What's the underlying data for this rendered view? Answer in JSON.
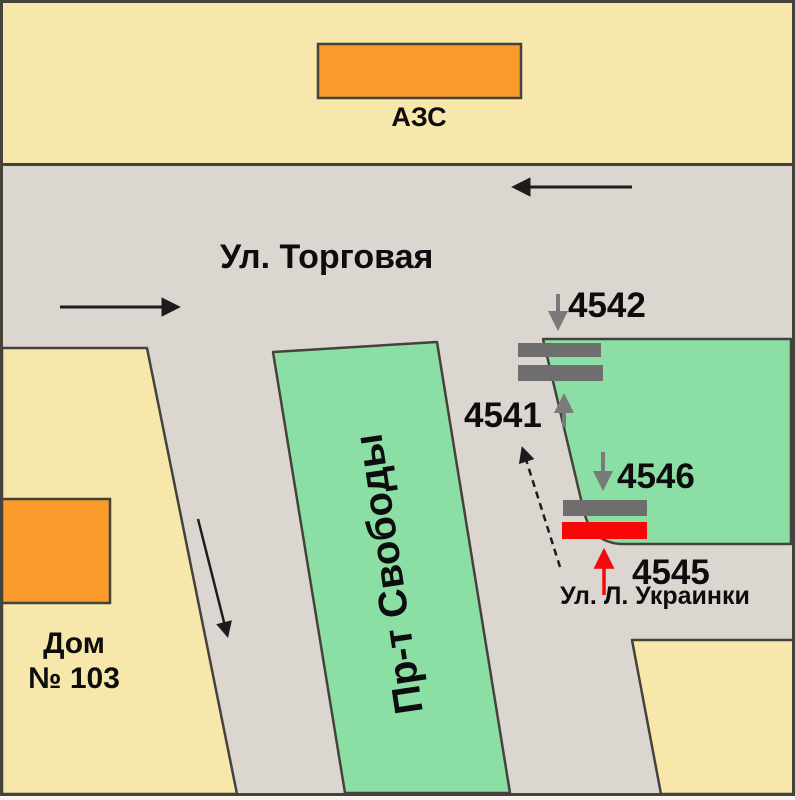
{
  "labels": {
    "gas_station": "АЗС",
    "street_torgovaya": "Ул. Торговая",
    "prospekt_svobody": "Пр-т Свободы",
    "house_line1": "Дом",
    "house_line2": "№ 103",
    "street_ukrainki": "Ул. Л. Украинки"
  },
  "billboards": [
    {
      "id": "4542"
    },
    {
      "id": "4541"
    },
    {
      "id": "4546"
    },
    {
      "id": "4545"
    }
  ],
  "colors": {
    "block_fill": "#f7e7ab",
    "road_fill": "#dcd6d1",
    "green_fill": "#8bdfa4",
    "building_fill": "#f99a2b",
    "panel_gray": "#6e6e6e",
    "panel_red": "#f70707",
    "outline": "#45423c",
    "arrow_black": "#1c1c1c",
    "arrow_gray": "#7a7a7a",
    "arrow_red": "#f40a0a",
    "text": "#0d0d0d",
    "bottom_strip": "#fdf1ee"
  }
}
